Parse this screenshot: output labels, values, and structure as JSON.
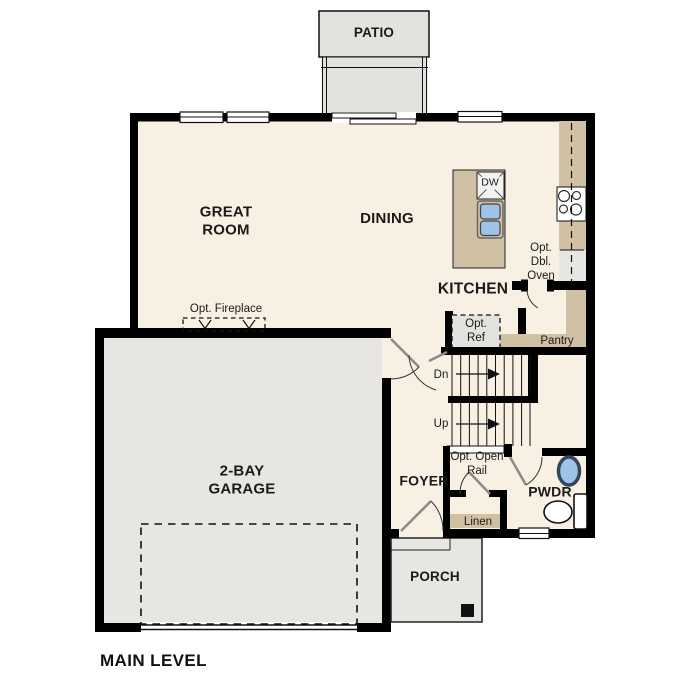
{
  "title": "MAIN LEVEL",
  "rooms": {
    "patio": "PATIO",
    "great_room": "GREAT ROOM",
    "dining": "DINING",
    "kitchen": "KITCHEN",
    "garage": "2-BAY GARAGE",
    "foyer": "FOYER",
    "powder": "PWDR",
    "porch": "PORCH",
    "pantry": "Pantry",
    "linen": "Linen"
  },
  "labels": {
    "fireplace": "Opt. Fireplace",
    "double_oven": "Opt. Dbl. Oven",
    "refrigerator": "Opt. Ref",
    "open_rail": "Opt. Open Rail",
    "stairs_down": "Dn",
    "stairs_up": "Up",
    "dishwasher": "DW"
  },
  "colors": {
    "floor": "#f8f1e3",
    "concrete": "#e7e6e2",
    "patio": "#e3e2df",
    "cabinet": "#d0c1a5",
    "sink_fill": "#9ec3e6",
    "wall": "#000000"
  }
}
